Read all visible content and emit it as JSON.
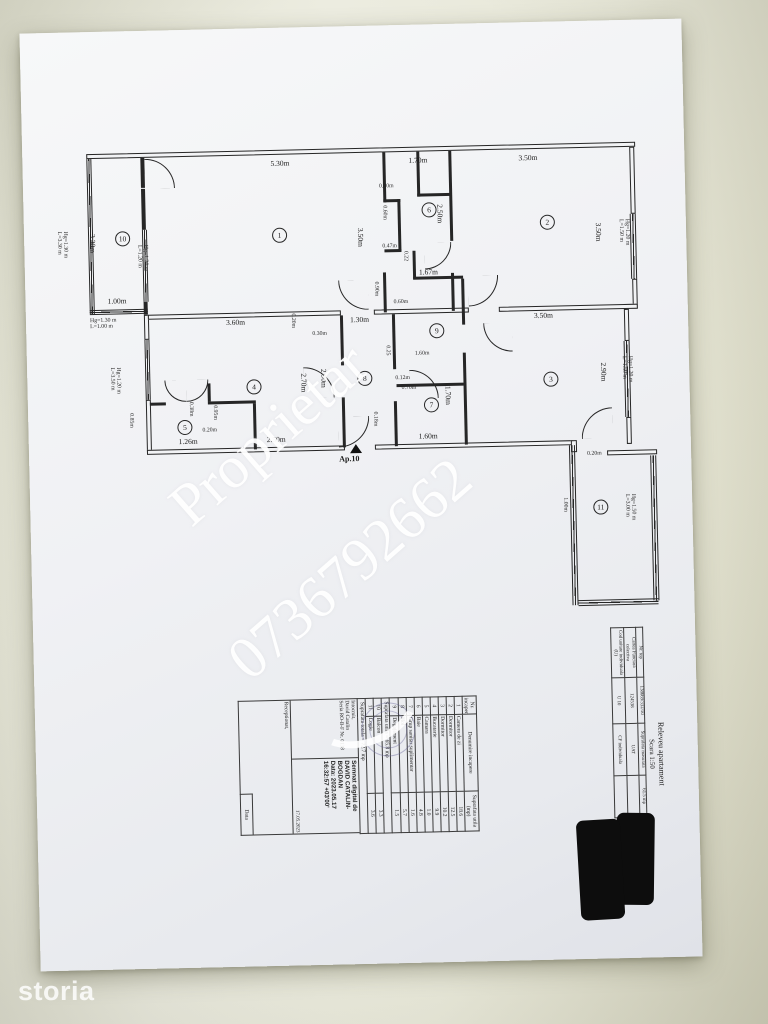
{
  "watermark": {
    "name": "Proprietar",
    "phone": "0736792662"
  },
  "brand": {
    "logo": "storia"
  },
  "plan": {
    "entrance": "Ap.10",
    "rooms": [
      {
        "t": "1",
        "x": 190,
        "y": 86
      },
      {
        "t": "2",
        "x": 458,
        "y": 79
      },
      {
        "t": "3",
        "x": 458,
        "y": 236
      },
      {
        "t": "4",
        "x": 161,
        "y": 237
      },
      {
        "t": "5",
        "x": 91,
        "y": 276
      },
      {
        "t": "6",
        "x": 340,
        "y": 64
      },
      {
        "t": "7",
        "x": 338,
        "y": 259
      },
      {
        "t": "8",
        "x": 272,
        "y": 231
      },
      {
        "t": "9",
        "x": 345,
        "y": 185
      },
      {
        "t": "10",
        "x": 33,
        "y": 86
      },
      {
        "t": "11",
        "x": 505,
        "y": 365
      }
    ],
    "walls": [
      {
        "x": 6,
        "y": 8,
        "w": 549,
        "h": 5,
        "cls": "hollow"
      },
      {
        "x": 60,
        "y": 13,
        "w": 4,
        "h": 30
      },
      {
        "x": 60,
        "y": 44,
        "w": 4,
        "h": 41
      },
      {
        "x": 60,
        "y": 157,
        "w": 4,
        "h": 13
      },
      {
        "x": 60,
        "y": 170,
        "w": 5,
        "h": 25,
        "cls": "hollow"
      },
      {
        "x": 60,
        "y": 255,
        "w": 5,
        "h": 52,
        "cls": "hollow"
      },
      {
        "x": 60,
        "y": 305,
        "w": 198,
        "h": 5,
        "cls": "hollow"
      },
      {
        "x": 288,
        "y": 305,
        "w": 198,
        "h": 5,
        "cls": "hollow"
      },
      {
        "x": 549,
        "y": 13,
        "w": 5,
        "h": 67,
        "cls": "hollow"
      },
      {
        "x": 549,
        "y": 145,
        "w": 5,
        "h": 30,
        "cls": "hollow"
      },
      {
        "x": 540,
        "y": 170,
        "w": 14,
        "h": 5,
        "cls": "hollow"
      },
      {
        "x": 540,
        "y": 175,
        "w": 5,
        "h": 32,
        "cls": "hollow"
      },
      {
        "x": 540,
        "y": 283,
        "w": 5,
        "h": 27,
        "cls": "hollow"
      },
      {
        "x": 64,
        "y": 170,
        "w": 193,
        "h": 5,
        "cls": "hollow"
      },
      {
        "x": 290,
        "y": 170,
        "w": 95,
        "h": 5,
        "cls": "hollow"
      },
      {
        "x": 415,
        "y": 170,
        "w": 139,
        "h": 5,
        "cls": "hollow"
      },
      {
        "x": 302,
        "y": 13,
        "w": 3,
        "h": 50
      },
      {
        "x": 302,
        "y": 60,
        "w": 17,
        "h": 3
      },
      {
        "x": 316,
        "y": 60,
        "w": 3,
        "h": 52
      },
      {
        "x": 302,
        "y": 110,
        "w": 17,
        "h": 3
      },
      {
        "x": 300,
        "y": 133,
        "w": 3,
        "h": 40
      },
      {
        "x": 330,
        "y": 112,
        "w": 3,
        "h": 28
      },
      {
        "x": 330,
        "y": 138,
        "w": 50,
        "h": 3
      },
      {
        "x": 368,
        "y": 13,
        "w": 3,
        "h": 90
      },
      {
        "x": 368,
        "y": 135,
        "w": 3,
        "h": 38
      },
      {
        "x": 336,
        "y": 13,
        "w": 3,
        "h": 45
      },
      {
        "x": 336,
        "y": 55,
        "w": 34,
        "h": 3
      },
      {
        "x": 256,
        "y": 175,
        "w": 3,
        "h": 50
      },
      {
        "x": 256,
        "y": 257,
        "w": 3,
        "h": 50
      },
      {
        "x": 308,
        "y": 175,
        "w": 3,
        "h": 55
      },
      {
        "x": 308,
        "y": 262,
        "w": 3,
        "h": 45
      },
      {
        "x": 378,
        "y": 141,
        "w": 3,
        "h": 46
      },
      {
        "x": 378,
        "y": 215,
        "w": 3,
        "h": 92
      },
      {
        "x": 311,
        "y": 245,
        "w": 67,
        "h": 3
      },
      {
        "x": 64,
        "y": 258,
        "w": 16,
        "h": 3
      },
      {
        "x": 122,
        "y": 258,
        "w": 48,
        "h": 3
      },
      {
        "x": 167,
        "y": 261,
        "w": 3,
        "h": 46
      },
      {
        "x": 122,
        "y": 240,
        "w": 3,
        "h": 18
      },
      {
        "x": 520,
        "y": 316,
        "w": 50,
        "h": 5,
        "cls": "hollow"
      },
      {
        "x": 484,
        "y": 305,
        "w": 6,
        "h": 12,
        "cls": "hollow"
      }
    ],
    "windows": [
      {
        "x": 6,
        "y": 13,
        "w": 5,
        "h": 155
      },
      {
        "x": 6,
        "y": 164,
        "w": 58,
        "h": 5,
        "cls": "winh"
      },
      {
        "x": 60,
        "y": 85,
        "w": 5,
        "h": 72
      },
      {
        "x": 60,
        "y": 195,
        "w": 5,
        "h": 60
      },
      {
        "x": 548,
        "y": 80,
        "w": 6,
        "h": 65
      },
      {
        "x": 539,
        "y": 207,
        "w": 6,
        "h": 76
      },
      {
        "x": 482,
        "y": 310,
        "w": 6,
        "h": 160
      },
      {
        "x": 488,
        "y": 465,
        "w": 80,
        "h": 6,
        "cls": "winh"
      },
      {
        "x": 563,
        "y": 322,
        "w": 6,
        "h": 145
      }
    ],
    "doors": [
      {
        "x": 64,
        "y": 14,
        "w": 30,
        "h": 30,
        "cls": "tr"
      },
      {
        "x": 255,
        "y": 140,
        "w": 30,
        "h": 30,
        "cls": "bl"
      },
      {
        "x": 385,
        "y": 138,
        "w": 30,
        "h": 31,
        "cls": "br"
      },
      {
        "x": 342,
        "y": 104,
        "w": 27,
        "h": 27,
        "cls": "br"
      },
      {
        "x": 218,
        "y": 226,
        "w": 31,
        "h": 31,
        "cls": "tr"
      },
      {
        "x": 399,
        "y": 186,
        "w": 29,
        "h": 29,
        "cls": "bl"
      },
      {
        "x": 324,
        "y": 231,
        "w": 29,
        "h": 29,
        "cls": "tr"
      },
      {
        "x": 79,
        "y": 236,
        "w": 22,
        "h": 22,
        "cls": "bl"
      },
      {
        "x": 101,
        "y": 236,
        "w": 22,
        "h": 22,
        "cls": "br"
      },
      {
        "x": 252,
        "y": 276,
        "w": 31,
        "h": 31,
        "cls": "br"
      },
      {
        "x": 495,
        "y": 273,
        "w": 31,
        "h": 31,
        "cls": "tl"
      }
    ],
    "dims": [
      {
        "t": "5.30m",
        "x": 190,
        "y": 18
      },
      {
        "t": "1.70m",
        "x": 328,
        "y": 18
      },
      {
        "t": "3.50m",
        "x": 438,
        "y": 18
      },
      {
        "t": "3.30m",
        "x": 14,
        "y": 88,
        "r": 90
      },
      {
        "t": "Hg=1.30 m\nL=3.30 m",
        "x": -14,
        "y": 85,
        "r": 90,
        "cls": "small"
      },
      {
        "t": "Hg=1.20 m\nL=1.20 m",
        "x": 66,
        "y": 100,
        "r": 90,
        "cls": "small"
      },
      {
        "t": "3.50m",
        "x": 282,
        "y": 88,
        "r": 90
      },
      {
        "t": "0.20m",
        "x": 298,
        "y": 44,
        "cls": "small"
      },
      {
        "t": "0.60m",
        "x": 306,
        "y": 66,
        "r": 90,
        "cls": "small"
      },
      {
        "t": "2.50m",
        "x": 362,
        "y": 66,
        "r": 90
      },
      {
        "t": "3.50m",
        "x": 520,
        "y": 88,
        "r": 90
      },
      {
        "t": "Hg=1.20 m\nL=1.50 m",
        "x": 548,
        "y": 85,
        "r": 90,
        "cls": "small"
      },
      {
        "t": "1.00m",
        "x": 24,
        "y": 152
      },
      {
        "t": "Hg=1.30 m\nL=1.00 m",
        "x": 6,
        "y": 172,
        "cls": "small"
      },
      {
        "t": "0.47m",
        "x": 300,
        "y": 104,
        "cls": "small"
      },
      {
        "t": "0.22",
        "x": 326,
        "y": 112,
        "r": 90,
        "cls": "small"
      },
      {
        "t": "1.67m",
        "x": 336,
        "y": 130
      },
      {
        "t": "0.90m",
        "x": 296,
        "y": 142,
        "r": 90,
        "cls": "small"
      },
      {
        "t": "0.60m",
        "x": 310,
        "y": 160,
        "cls": "small"
      },
      {
        "t": "3.60m",
        "x": 142,
        "y": 176
      },
      {
        "t": "0.20m",
        "x": 212,
        "y": 172,
        "r": 90,
        "cls": "small"
      },
      {
        "t": "0.30m",
        "x": 228,
        "y": 190,
        "cls": "small"
      },
      {
        "t": "1.30m",
        "x": 266,
        "y": 176
      },
      {
        "t": "2.70m",
        "x": 222,
        "y": 232,
        "r": 90
      },
      {
        "t": "2.90m",
        "x": 242,
        "y": 228,
        "r": 90
      },
      {
        "t": "Hg=1.20 m\nL=3.50 m",
        "x": 36,
        "y": 222,
        "r": 90,
        "cls": "small"
      },
      {
        "t": "0.95m",
        "x": 132,
        "y": 262,
        "r": 90,
        "cls": "small"
      },
      {
        "t": "0.38m",
        "x": 108,
        "y": 258,
        "r": 90,
        "cls": "small"
      },
      {
        "t": "0.20m",
        "x": 116,
        "y": 284,
        "cls": "small"
      },
      {
        "t": "0.85m",
        "x": 48,
        "y": 268,
        "r": 90,
        "cls": "small"
      },
      {
        "t": "1.26m",
        "x": 92,
        "y": 294
      },
      {
        "t": "2.50m",
        "x": 180,
        "y": 294
      },
      {
        "t": "0.18m",
        "x": 292,
        "y": 272,
        "r": 90,
        "cls": "small"
      },
      {
        "t": "1.60m",
        "x": 332,
        "y": 294
      },
      {
        "t": "0.25",
        "x": 306,
        "y": 206,
        "r": 90,
        "cls": "small"
      },
      {
        "t": "1.60m",
        "x": 330,
        "y": 212,
        "cls": "small"
      },
      {
        "t": "0.12m",
        "x": 310,
        "y": 236,
        "cls": "small"
      },
      {
        "t": "0.70m",
        "x": 316,
        "y": 246,
        "cls": "small"
      },
      {
        "t": "1.70m",
        "x": 366,
        "y": 248,
        "r": 90
      },
      {
        "t": "3.50m",
        "x": 450,
        "y": 176
      },
      {
        "t": "2.90m",
        "x": 522,
        "y": 228,
        "r": 90
      },
      {
        "t": "Hg=1.20 m\nL=1.50 m",
        "x": 548,
        "y": 222,
        "r": 90,
        "cls": "small"
      },
      {
        "t": "0.20m",
        "x": 500,
        "y": 316,
        "cls": "small"
      },
      {
        "t": "1.00m",
        "x": 480,
        "y": 362,
        "r": 90,
        "cls": "small"
      },
      {
        "t": "Hg=1.50 m\nL=3.00 m",
        "x": 548,
        "y": 360,
        "r": 90,
        "cls": "small"
      }
    ]
  },
  "legend": {
    "headers": [
      "Nr. incapere",
      "Denumire incapere",
      "Suprafata utila (mp)"
    ],
    "rows": [
      [
        "1",
        "Camera de zi",
        "18.6"
      ],
      [
        "2",
        "Dormitor",
        "12.5"
      ],
      [
        "3",
        "Dormitor",
        "10.2"
      ],
      [
        "4",
        "Bucatarie",
        "9.9"
      ],
      [
        "5",
        "Camara",
        "1.0"
      ],
      [
        "6",
        "Baie",
        "4.8"
      ],
      [
        "7",
        "Grup sanitar suplimentar",
        "1.6"
      ],
      [
        "8",
        "Hol",
        "5.7"
      ],
      [
        "9",
        "Degajament",
        "1.5"
      ],
      [
        "Suprafata utila = 65.8 mp"
      ],
      [
        "10",
        "Balcon",
        "3.3"
      ],
      [
        "11",
        "Logie",
        "3.6"
      ],
      [
        "Suprafata totala = 72.7 mp"
      ]
    ],
    "intocmit_label": "Intocmit,",
    "intocmit_name": "David Catalin",
    "seria": "Seria RO-B-F Nr. 0138",
    "semnat_l1": "Semnat digital",
    "semnat_l2": "de DAVID",
    "semnat_l3": "CATALIN-",
    "semnat_l4": "BOGDAN",
    "semnat_l5": "Data: 2023.05.17",
    "semnat_l6": "16:32:57 +03'00'",
    "date": "17.05.2023",
    "receptionat": "Receptionat,",
    "data_label": "Data"
  },
  "cadastral": {
    "title": "Releveu apartament",
    "scale": "Scara 1:50",
    "rows": [
      [
        "Nr. top",
        "138669/332/10",
        "Suprafata masurata",
        "61.5 mp"
      ],
      [
        "Cartea Funciara colectiva",
        "124538",
        "UAT",
        ""
      ],
      [
        "Cod unitate individuala (U)",
        "U 10",
        "CF individuala",
        ""
      ]
    ]
  }
}
